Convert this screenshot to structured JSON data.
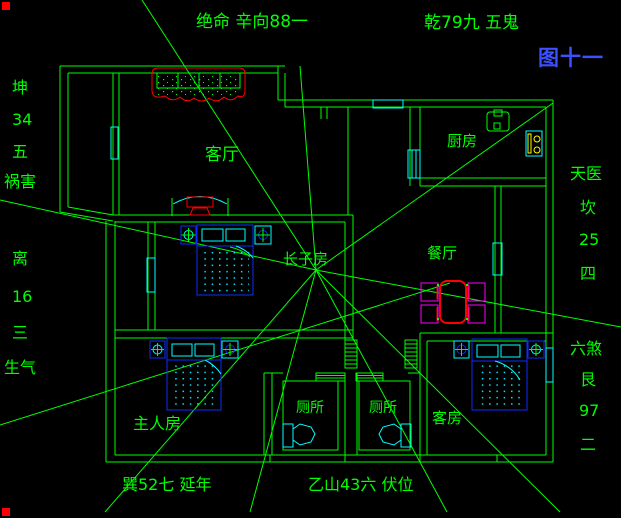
{
  "figure": {
    "caption": "图十一"
  },
  "compass_annotations": {
    "top_left": "绝命 辛向88一",
    "top_right": "乾79九 五鬼",
    "left": [
      "坤",
      "34",
      "五",
      "祸害",
      "离",
      "16",
      "三",
      "生气"
    ],
    "right": [
      "天医",
      "坎",
      "25",
      "四",
      "六煞",
      "艮",
      "97",
      "二"
    ],
    "bottom_left": "巽52七 延年",
    "bottom_right": "乙山43六 伏位"
  },
  "rooms": {
    "living_room": "客厅",
    "kitchen": "厨房",
    "dining_room": "餐厅",
    "eldest_son_room": "长子房",
    "master_bedroom": "主人房",
    "toilet_left": "厕所",
    "toilet_right": "厕所",
    "guest_room": "客房"
  },
  "colors": {
    "background": "#000000",
    "wall_line": "#00ff00",
    "window_cyan": "#00ffff",
    "furniture_blue": "#0f2bff",
    "accent_red": "#ff0000",
    "chair_magenta": "#ff00ff",
    "stove_yellow": "#ffff00",
    "figure_label_blue": "#3c50ff"
  }
}
